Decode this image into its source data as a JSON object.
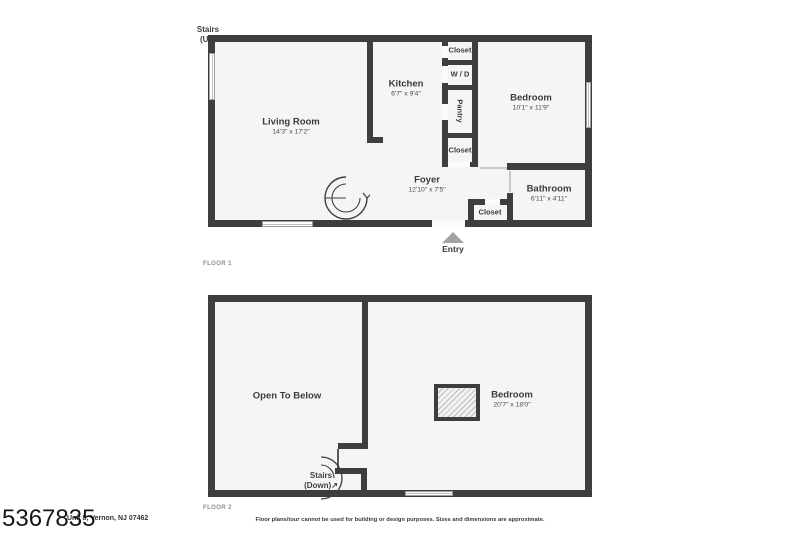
{
  "watermark": "5367835",
  "footer": {
    "address": "Unit 8, Vernon, NJ 07462",
    "disclaimer": "Floor plans/tour cannot be used for building or design purposes. Sizes and dimensions are approximate."
  },
  "colors": {
    "wall": "#3e3e3e",
    "floor_fill": "#f5f5f3",
    "background": "#ffffff",
    "entry_marker": "#a3a3a3"
  },
  "floor1": {
    "label": "FLOOR 1",
    "entry": "Entry",
    "stairs": {
      "line1": "Stairs",
      "line2": "(Up)"
    },
    "rooms": {
      "living_room": {
        "name": "Living Room",
        "dims": "14'3\" x 17'2\""
      },
      "kitchen": {
        "name": "Kitchen",
        "dims": "6'7\" x 9'4\""
      },
      "bedroom": {
        "name": "Bedroom",
        "dims": "10'1\" x 11'9\""
      },
      "foyer": {
        "name": "Foyer",
        "dims": "12'10\" x 7'5\""
      },
      "bathroom": {
        "name": "Bathroom",
        "dims": "6'11\" x 4'11\""
      },
      "closet_top": {
        "name": "Closet"
      },
      "wd": {
        "name": "W / D"
      },
      "pantry": {
        "name": "Pantry"
      },
      "closet_mid": {
        "name": "Closet"
      },
      "closet_foyer": {
        "name": "Closet"
      }
    }
  },
  "floor2": {
    "label": "FLOOR 2",
    "stairs": {
      "line1": "Stairs",
      "line2": "(Down)↗"
    },
    "rooms": {
      "open_to_below": {
        "name": "Open To Below"
      },
      "bedroom": {
        "name": "Bedroom",
        "dims": "20'7\" x 18'0\""
      }
    }
  }
}
